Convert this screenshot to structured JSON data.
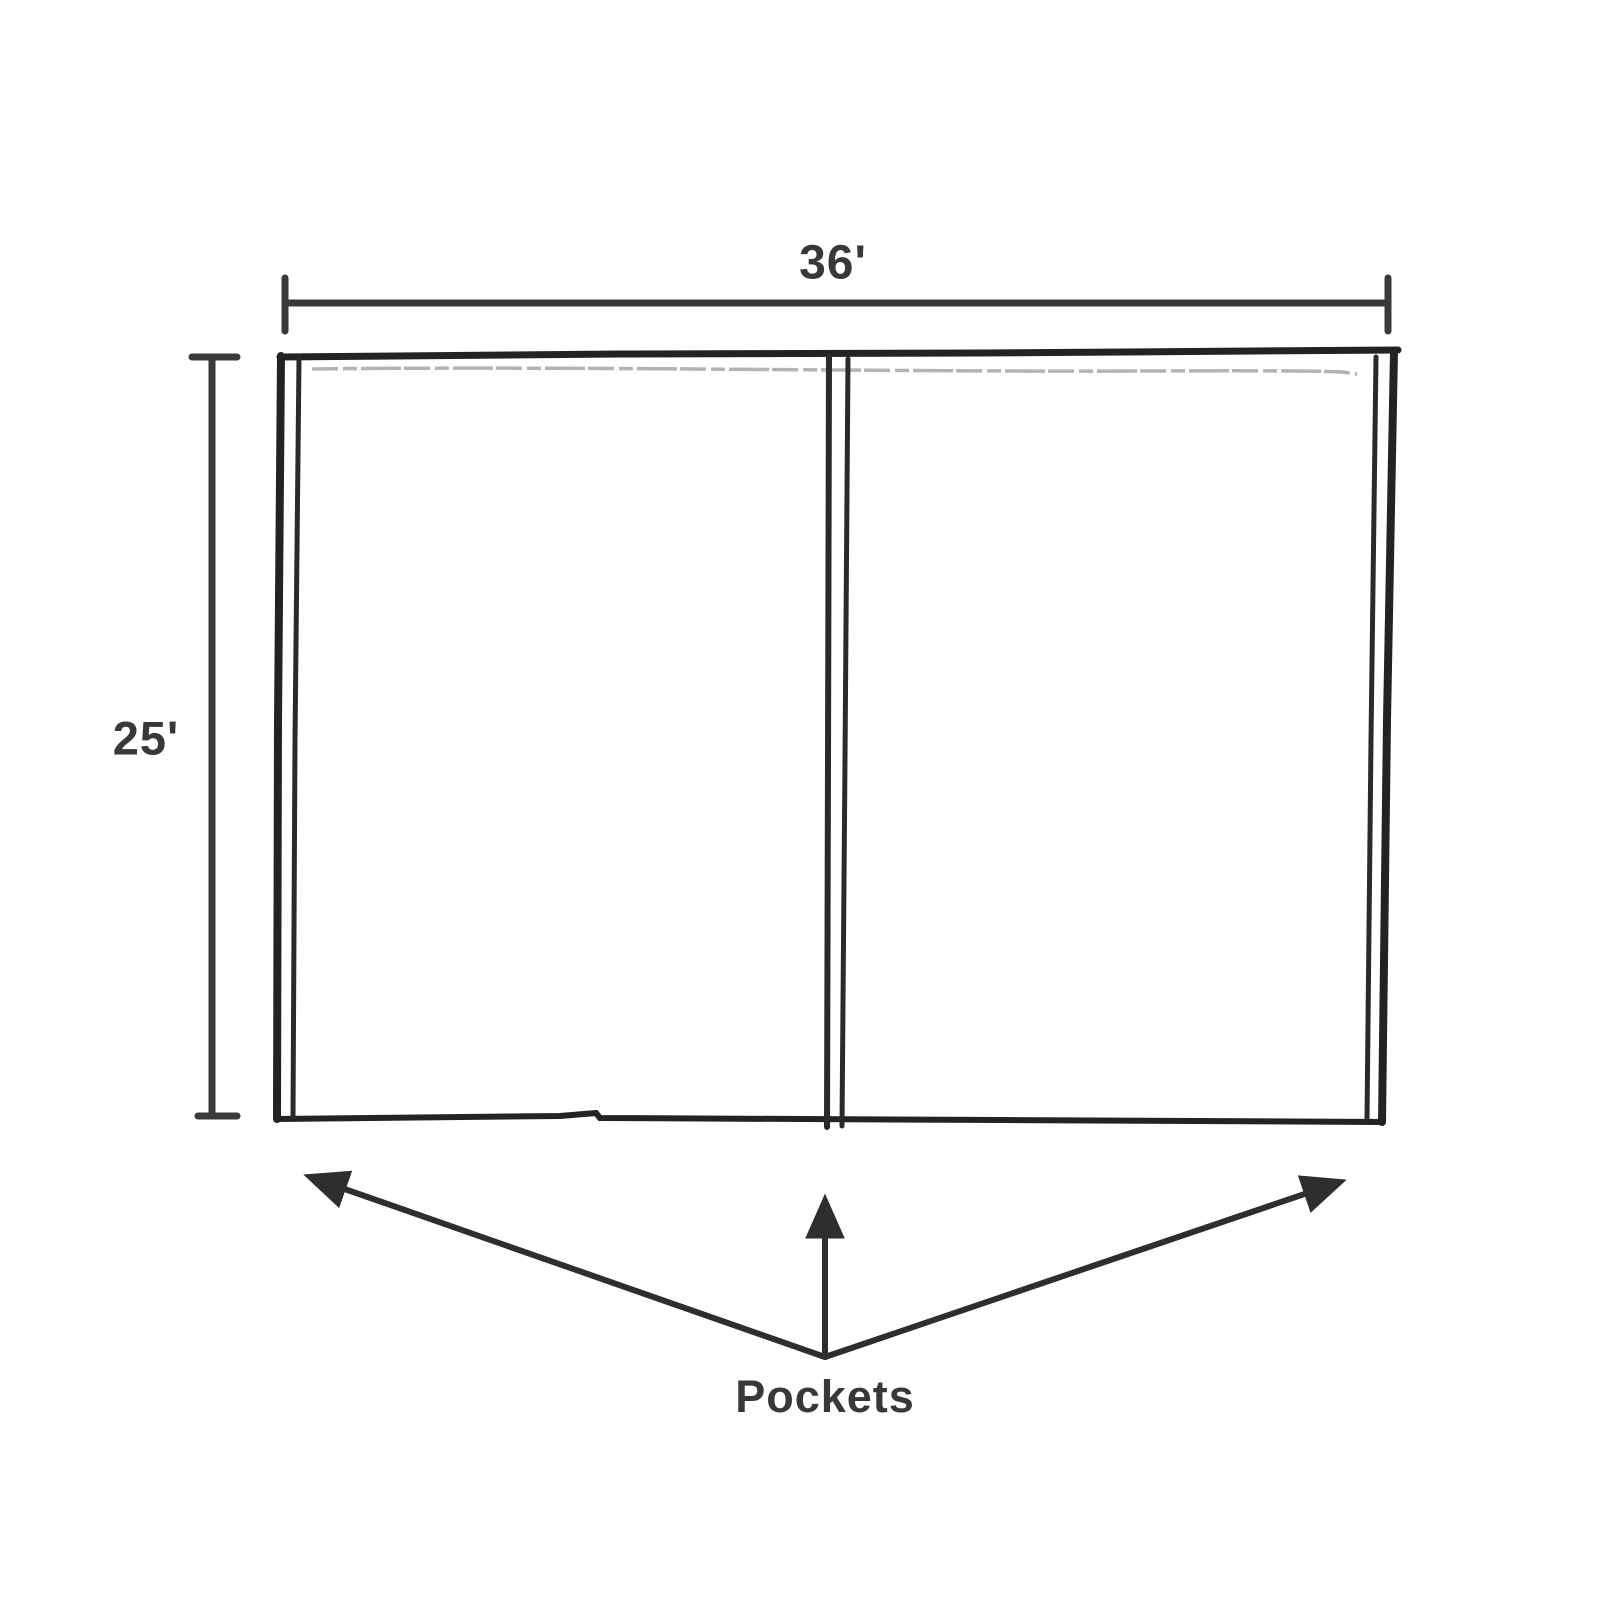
{
  "diagram": {
    "kind": "hand-drawn technical sketch of a rectangular cover with pocket seams",
    "width_dimension": "36'",
    "height_dimension": "25'",
    "callout_label": "Pockets",
    "pocket_positions": [
      "left-edge",
      "center",
      "right-edge"
    ],
    "colors": {
      "outline": "#232323",
      "dimension_line": "#3a3a3a",
      "arrow": "#2e2e2e",
      "sketch_faint_line": "#b3b3b3",
      "text": "#383838",
      "background": "#ffffff"
    }
  }
}
